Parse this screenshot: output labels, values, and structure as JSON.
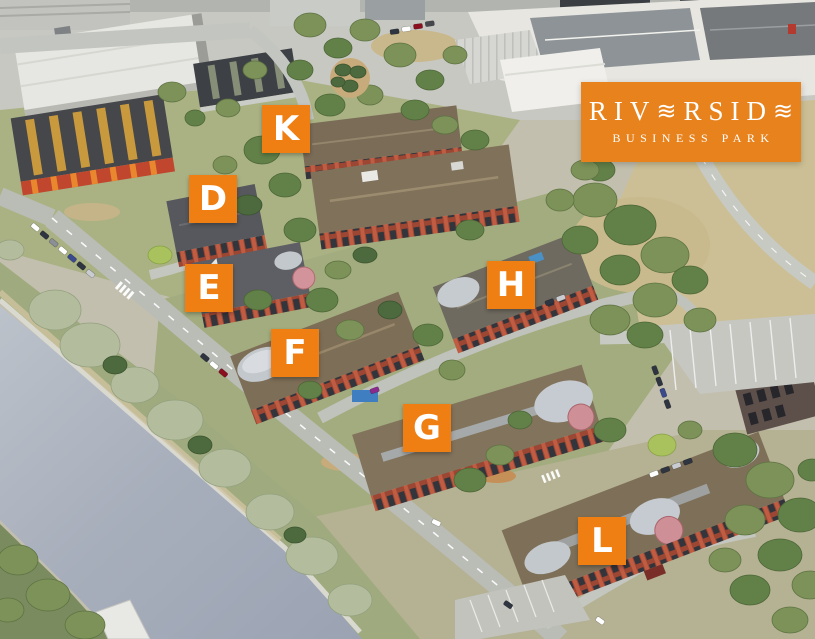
{
  "logo": {
    "text_part1": "RIV",
    "wave_glyph": "≋",
    "text_part2": "RSID",
    "tagline": "BUSINESS PARK",
    "bg_color": "#e8821d",
    "text_color": "#ffffff"
  },
  "building_labels": {
    "color": "#ef7f12",
    "text_color": "#ffffff",
    "size": 48,
    "items": [
      {
        "letter": "K",
        "x": 262,
        "y": 105
      },
      {
        "letter": "D",
        "x": 189,
        "y": 175
      },
      {
        "letter": "E",
        "x": 185,
        "y": 264
      },
      {
        "letter": "F",
        "x": 271,
        "y": 329
      },
      {
        "letter": "G",
        "x": 403,
        "y": 404
      },
      {
        "letter": "H",
        "x": 487,
        "y": 261
      },
      {
        "letter": "L",
        "x": 578,
        "y": 517
      }
    ]
  }
}
